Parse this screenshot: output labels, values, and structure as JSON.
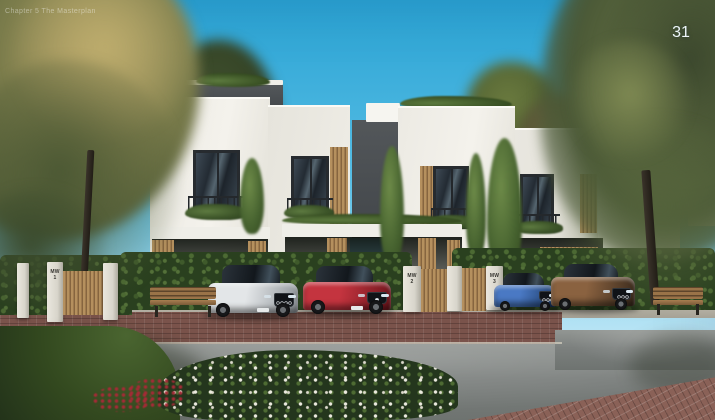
{
  "page": {
    "number": "31",
    "watermark": "Chapter 5 The Masterplan"
  },
  "scene": {
    "title": "Architectural rendering of a row of modern white townhouses with wood accents, garden hedges, benches and parked cars",
    "units": [
      {
        "code": "MW",
        "number": "1"
      },
      {
        "code": "MW",
        "number": "2"
      },
      {
        "code": "MW",
        "number": "3"
      }
    ],
    "cars": [
      {
        "name": "silver-sedan",
        "body": "#e3e6e8",
        "shade": "#8f959a"
      },
      {
        "name": "red-coupe",
        "body": "#c4343f",
        "shade": "#6e151c"
      },
      {
        "name": "blue-sedan",
        "body": "#4a79c4",
        "shade": "#1c3a66"
      },
      {
        "name": "bronze-suv",
        "body": "#8a6240",
        "shade": "#3a2a1c"
      }
    ],
    "colors": {
      "sky_top": "#2aa3d4",
      "sky_mid": "#56bde4",
      "sky_bottom": "#b5e3f4",
      "facade": "#f4f2ec",
      "fascia": "#42464a",
      "wood": "#b08a58",
      "hedge": "#2a401f",
      "road": "#7c807e",
      "brick": "#7a534b"
    }
  }
}
